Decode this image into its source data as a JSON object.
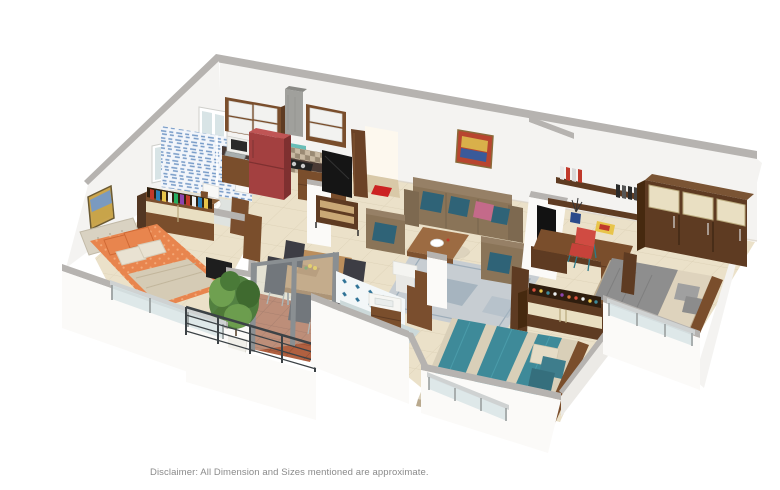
{
  "page": {
    "background_color": "#ffffff",
    "disclaimer": "Disclaimer: All Dimension and Sizes mentioned are approximate."
  },
  "scene": {
    "kind": "3d-isometric-apartment-floor-plan-render",
    "rooms": [
      {
        "name": "kitchen",
        "items": [
          "upper-cabinets",
          "chimney-hood",
          "checker-backsplash",
          "counter-with-hob-and-sink",
          "red-refrigerator",
          "microwave",
          "base-cabinets",
          "window"
        ]
      },
      {
        "name": "bathroom-1",
        "items": [
          "blue-scribble-tiles",
          "toilet",
          "washbasin",
          "door",
          "window"
        ]
      },
      {
        "name": "bedroom-1",
        "items": [
          "orange-double-bed",
          "tufted-headboard",
          "dresser-with-books",
          "wall-painting",
          "glass-balustrade-window",
          "dark-panel"
        ]
      },
      {
        "name": "balcony",
        "items": [
          "potted-plant",
          "metal-railing",
          "terracotta-floor",
          "glass-partition"
        ]
      },
      {
        "name": "dining-area",
        "items": [
          "wooden-table",
          "five-dark-chairs",
          "fruit-tray",
          "yellow-flowers"
        ]
      },
      {
        "name": "living-room",
        "items": [
          "three-seater-sofa",
          "two-armchairs",
          "teal-pillows",
          "pink-pillow",
          "coffee-table",
          "white-bowl",
          "rug",
          "wall-painting",
          "tv-on-unit"
        ]
      },
      {
        "name": "entrance",
        "items": [
          "open-door",
          "red-doormat"
        ]
      },
      {
        "name": "bathroom-2",
        "items": [
          "diamond-tiles",
          "twin-washbasins",
          "wooden-vanity",
          "round-shower",
          "door"
        ]
      },
      {
        "name": "bedroom-2",
        "items": [
          "study-desk",
          "red-chair",
          "wall-shelves-with-books",
          "vase",
          "wardrobe-with-cream-panels",
          "gray-beige-double-bed",
          "glass-balustrade-window",
          "tv-panel"
        ]
      },
      {
        "name": "bedroom-3",
        "items": [
          "teal-striped-double-bed",
          "teal-pillows",
          "shoe-rack-wardrobe",
          "glass-balustrade-window",
          "door"
        ]
      }
    ]
  },
  "colors": {
    "page_bg": "#ffffff",
    "wall_top": "#b6b3b0",
    "wall_face": "#f4f3f1",
    "wall_bright": "#fbfaf8",
    "wall_shade": "#eceae6",
    "floor": "#ebe1c9",
    "floor_line": "#cfc3a6",
    "bath_floor": "#dfe3e0",
    "terracotta": "#b06040",
    "terracotta_line": "#8f4a30",
    "tile_blue": "#4a7bb5",
    "tile_teal": "#2e7296",
    "wood_dark": "#5e3b22",
    "wood_mid": "#7a4e2c",
    "wood_light": "#9c6b42",
    "wood_pale": "#bb8e5c",
    "cream": "#e9dfc2",
    "glossy_white": "#f2f2f0",
    "counter_dark": "#4a3a34",
    "chimney_gray": "#a0a09c",
    "fridge_red": "#a34040",
    "fridge_red_dark": "#7e3030",
    "fridge_red_top": "#c05555",
    "orange_bed": "#e8854e",
    "orange_light": "#f4a876",
    "blanket_beige": "#d5cbb5",
    "headboard_beige": "#d9d2c2",
    "teal_bed": "#3e8a99",
    "teal_bed_light": "#4da0ae",
    "bed_beige": "#d9cfb8",
    "gray_blanket": "#8e8e8e",
    "sheet_beige": "#ded3bd",
    "sofa_brown": "#8a7458",
    "sofa_brown_dark": "#7d6950",
    "sofa_back": "#968066",
    "pillow_teal": "#2f6377",
    "pillow_pink": "#c46a8a",
    "chair_dark": "#3d3d44",
    "chair_red": "#c7423a",
    "rug_gray": "#c7cdd2",
    "rug_blue": "#8ba0af",
    "plant_green": "#4a7a38",
    "plant_light": "#6fa050",
    "glass_blue": "#d8e4e6",
    "metal_gray": "#8a8f92",
    "rail_dark": "#3c4246",
    "door_brown": "#6b4226",
    "mat_red": "#cc2222",
    "text_gray": "#8a8a8a"
  }
}
